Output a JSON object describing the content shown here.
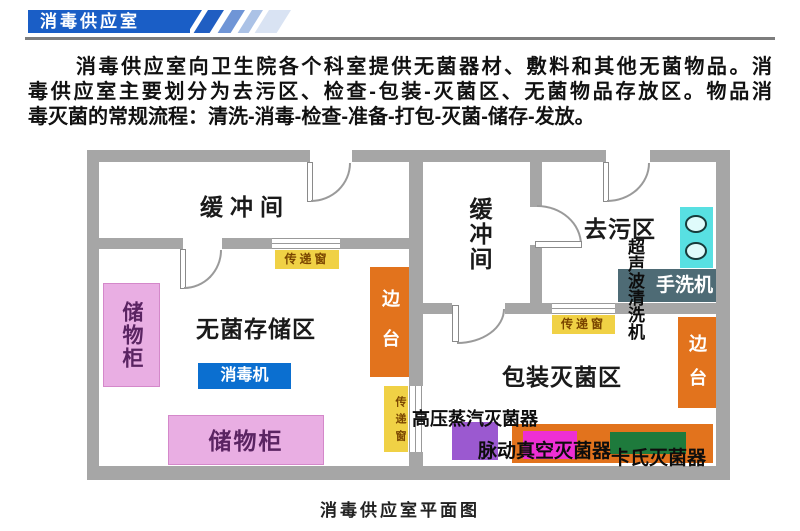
{
  "header": {
    "title": "消毒供应室"
  },
  "intro": {
    "line1": "消毒供应室向卫生院各个科室提供无菌器材、敷料和其他无菌物品。消",
    "line2": "毒供应室主要划分为去污区、检查-包装-灭菌区、无菌物品存放区。物品消",
    "line3": "毒灭菌的常规流程：清洗-消毒-检查-准备-打包-灭菌-储存-发放。"
  },
  "plan": {
    "caption": "消毒供应室平面图",
    "rooms": {
      "buffer_left": "缓冲间",
      "buffer_right": "缓冲间",
      "decontamination": "去污区",
      "sterile_storage": "无菌存储区",
      "packing_sterilization": "包装灭菌区"
    },
    "equipment": {
      "cabinet_left": "储物柜",
      "cabinet_bottom": "储物柜",
      "disinfector": "消毒机",
      "side_table_left": "边台",
      "side_table_right": "边台",
      "pass_window_top": "传递窗",
      "pass_window_mid": "传递窗",
      "pass_window_right": "传递窗",
      "ultrasonic_cleaner": "超声波清洗机",
      "hand_washer": "手洗机",
      "steam_sterilizer": "高压蒸汽灭菌器",
      "pulse_vacuum_sterilizer": "脉动真空灭菌器",
      "cassette_sterilizer": "卡氏灭菌器"
    },
    "colors": {
      "wall": "#a6a6a6",
      "banner_blue": "#1a5ec6",
      "cabinet_pink": "#e9aee3",
      "disinfector_blue": "#0b6fd0",
      "side_table_orange": "#e2731d",
      "pass_window_yellow": "#f0d145",
      "sink_cyan": "#58e0e2",
      "hand_washer_teal": "#4e6b75",
      "sterilizer_purple": "#9b59d0",
      "sterilizer_magenta": "#ee2fd4",
      "cassette_green": "#1e7a3c"
    }
  }
}
